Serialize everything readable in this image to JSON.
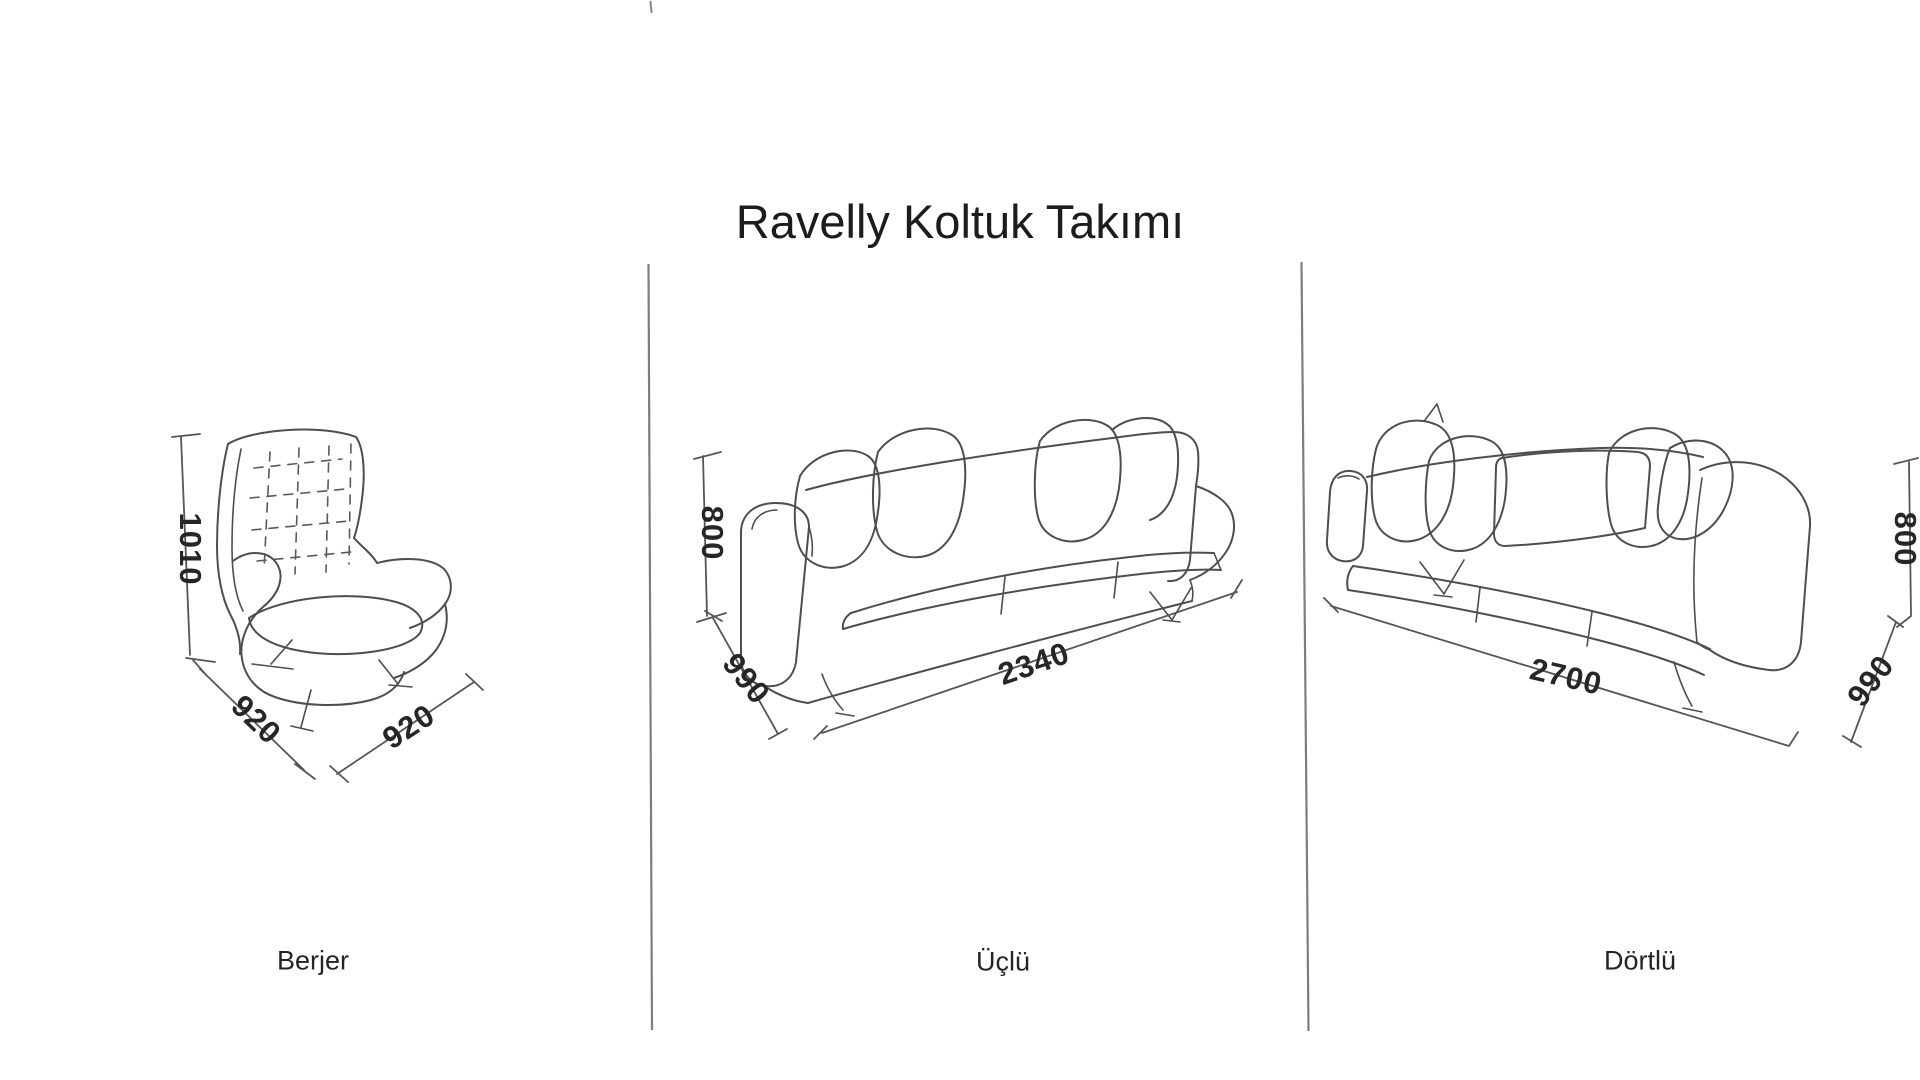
{
  "title": "Ravelly Koltuk Takımı",
  "sections": [
    {
      "caption": "Berjer",
      "dims": {
        "height": "1010",
        "depth": "920",
        "width": "920"
      }
    },
    {
      "caption": "Üçlü",
      "dims": {
        "height": "800",
        "depth": "990",
        "width": "2340"
      }
    },
    {
      "caption": "Dörtlü",
      "dims": {
        "height": "800",
        "depth": "990",
        "width": "2700"
      }
    }
  ],
  "colors": {
    "background": "#ffffff",
    "sketch_ink": "#4e4e4e",
    "dimension_ink": "#565656",
    "text": "#222222",
    "divider": "#7d7d7d"
  }
}
